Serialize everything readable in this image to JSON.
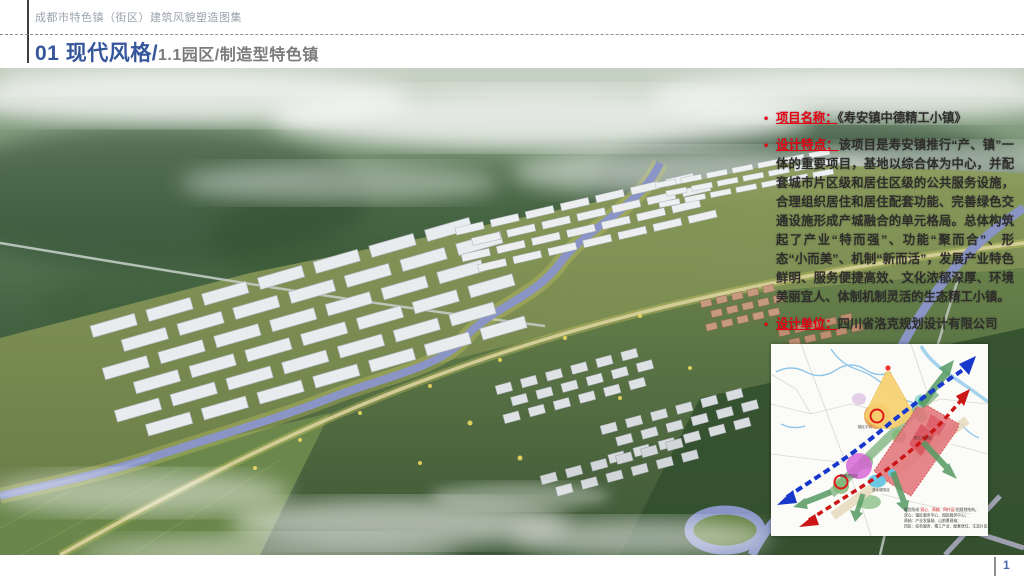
{
  "header": {
    "catalog_title": "成都市特色镇（街区）建筑风貌塑造图集",
    "section_title": "01 现代风格/",
    "section_subtitle": "1.1园区/制造型特色镇"
  },
  "colors": {
    "title_blue": "#35569b",
    "subtitle_gray": "#7b7b7b",
    "label_red": "#e60012",
    "body_text": "#2e2d2b",
    "page_number_blue": "#4a6cb3"
  },
  "info_panel": {
    "items": [
      {
        "label": "项目名称：",
        "text": "《寿安镇中德精工小镇》"
      },
      {
        "label": "设计特点：",
        "text": "该项目是寿安镇推行“产、镇”一体的重要项目，基地以综合体为中心，并配套城市片区级和居住区级的公共服务设施，合理组织居住和居住配套功能、完善绿色交通设施形成产城融合的单元格局。总体构筑起了产业“特而强”、功能“聚而合”、形态“小而美”、机制“新而活”，发展产业特色鲜明、服务便捷高效、文化浓郁深厚、环境美丽宜人、体制机制灵活的生态精工小镇。"
      },
      {
        "label": "设计单位：",
        "text": "四川省洛克规划设计有限公司"
      }
    ]
  },
  "map_inset": {
    "zone_labels": [
      "镇区中心",
      "精工产业区",
      "配套居住区",
      "滨水服务区"
    ],
    "legend_lines": {
      "intro_prefix": "规划形成",
      "intro_highlight": "“双心、两轴、四片区”",
      "intro_suffix": "的规划结构。",
      "line2": "双心：镇区服务中心、园区服务中心；",
      "line3": "两轴：产业发展轴、山前景观轴；",
      "line4": "四区：综合服务、精工产业、配套居住、生态片区。"
    }
  },
  "footer": {
    "page_number": "1"
  }
}
